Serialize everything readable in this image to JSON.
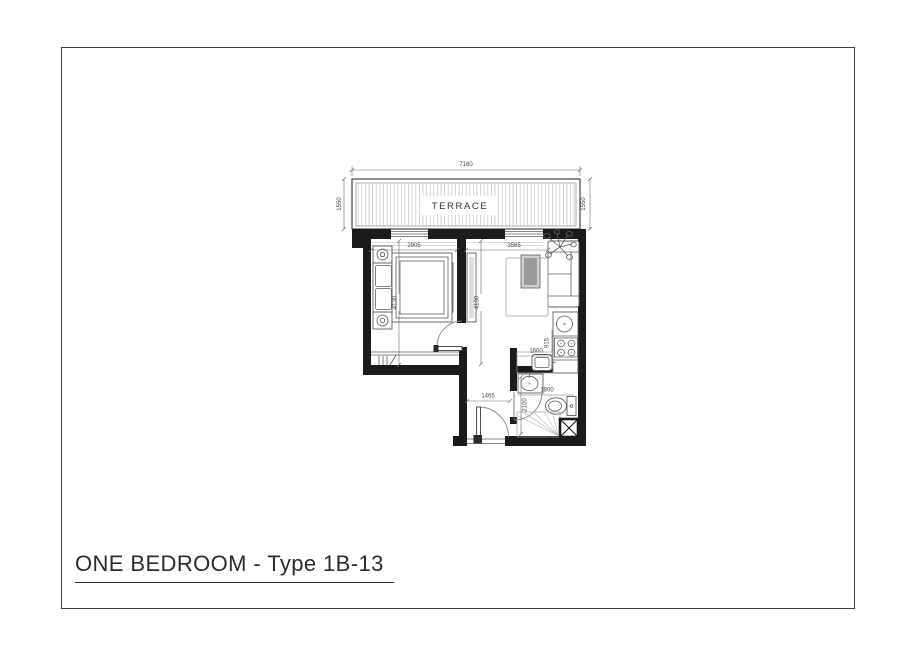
{
  "title": {
    "text": "ONE BEDROOM - Type 1B-13"
  },
  "plan": {
    "terrace_label": "TERRACE",
    "dims": {
      "terrace_width": "7160",
      "terrace_depth_left": "1550",
      "terrace_depth_right": "1550",
      "bedroom_width": "2905",
      "bedroom_depth": "4130",
      "living_width": "3565",
      "living_depth": "4130",
      "kitchen_counter": "915",
      "kitchen_run": "1600",
      "hall_width": "1465",
      "bath_width": "1800",
      "bath_depth": "2100"
    },
    "colors": {
      "wall": "#1b1b1b",
      "line": "#6a6a6a",
      "hatch": "#c9c9c9"
    }
  }
}
